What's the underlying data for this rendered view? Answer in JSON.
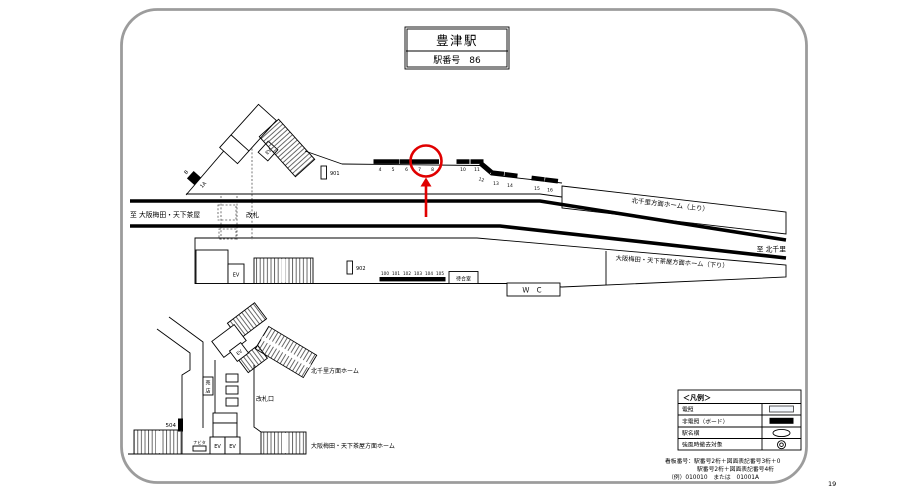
{
  "page_number": "19",
  "title_box": {
    "station_name": "豊津駅",
    "station_number": "駅番号　86"
  },
  "colors": {
    "annotation_red": "#e00000",
    "track_black": "#000000",
    "border_gray": "#9c9c9c"
  },
  "annotation": {
    "type": "circle-and-arrow",
    "color": "#e00000",
    "circled_sign": "8"
  },
  "track_level": {
    "direction_left": "至 大阪梅田・天下茶屋",
    "ticket_gate": "改札",
    "direction_right": "至 北千里",
    "up_platform": "北千里方面ホーム（上り）",
    "down_platform": "大阪梅田・天下茶屋方面ホーム（下り）",
    "waiting_room": "待合室",
    "toilet": "Ｗ Ｃ",
    "elevator": "EV",
    "sign_901": "901",
    "sign_902": "902",
    "sign_b": "B",
    "sign_1a": "1A",
    "up_sign_numbers": [
      "4",
      "5",
      "6",
      "7",
      "8",
      "10",
      "11",
      "12",
      "13",
      "14",
      "15",
      "16"
    ],
    "down_sign_numbers": [
      "100",
      "101",
      "102",
      "103",
      "104",
      "105"
    ]
  },
  "concourse_level": {
    "up_platform": "北千里方面ホーム",
    "down_platform": "大阪梅田・天下茶屋方面ホーム",
    "ticket_gate": "改札口",
    "shop": {
      "char1": "売",
      "char2": "店"
    },
    "sign_504": "504",
    "navita": "ナビタ",
    "elevator": "EV"
  },
  "legend": {
    "title": "＜凡例＞",
    "rows": [
      {
        "label": "電照",
        "symbol": "light-rect"
      },
      {
        "label": "非電照（ボード）",
        "symbol": "black-rect"
      },
      {
        "label": "駅名横",
        "symbol": "oval"
      },
      {
        "label": "強風時撤去対象",
        "symbol": "double-circle"
      }
    ]
  },
  "notes": {
    "line1": "看板番号：駅番号2桁＋図面表記番号3桁＋0",
    "line2": "駅番号2桁＋図面表記番号4桁",
    "line3": "（例）010010　または　01001A"
  }
}
